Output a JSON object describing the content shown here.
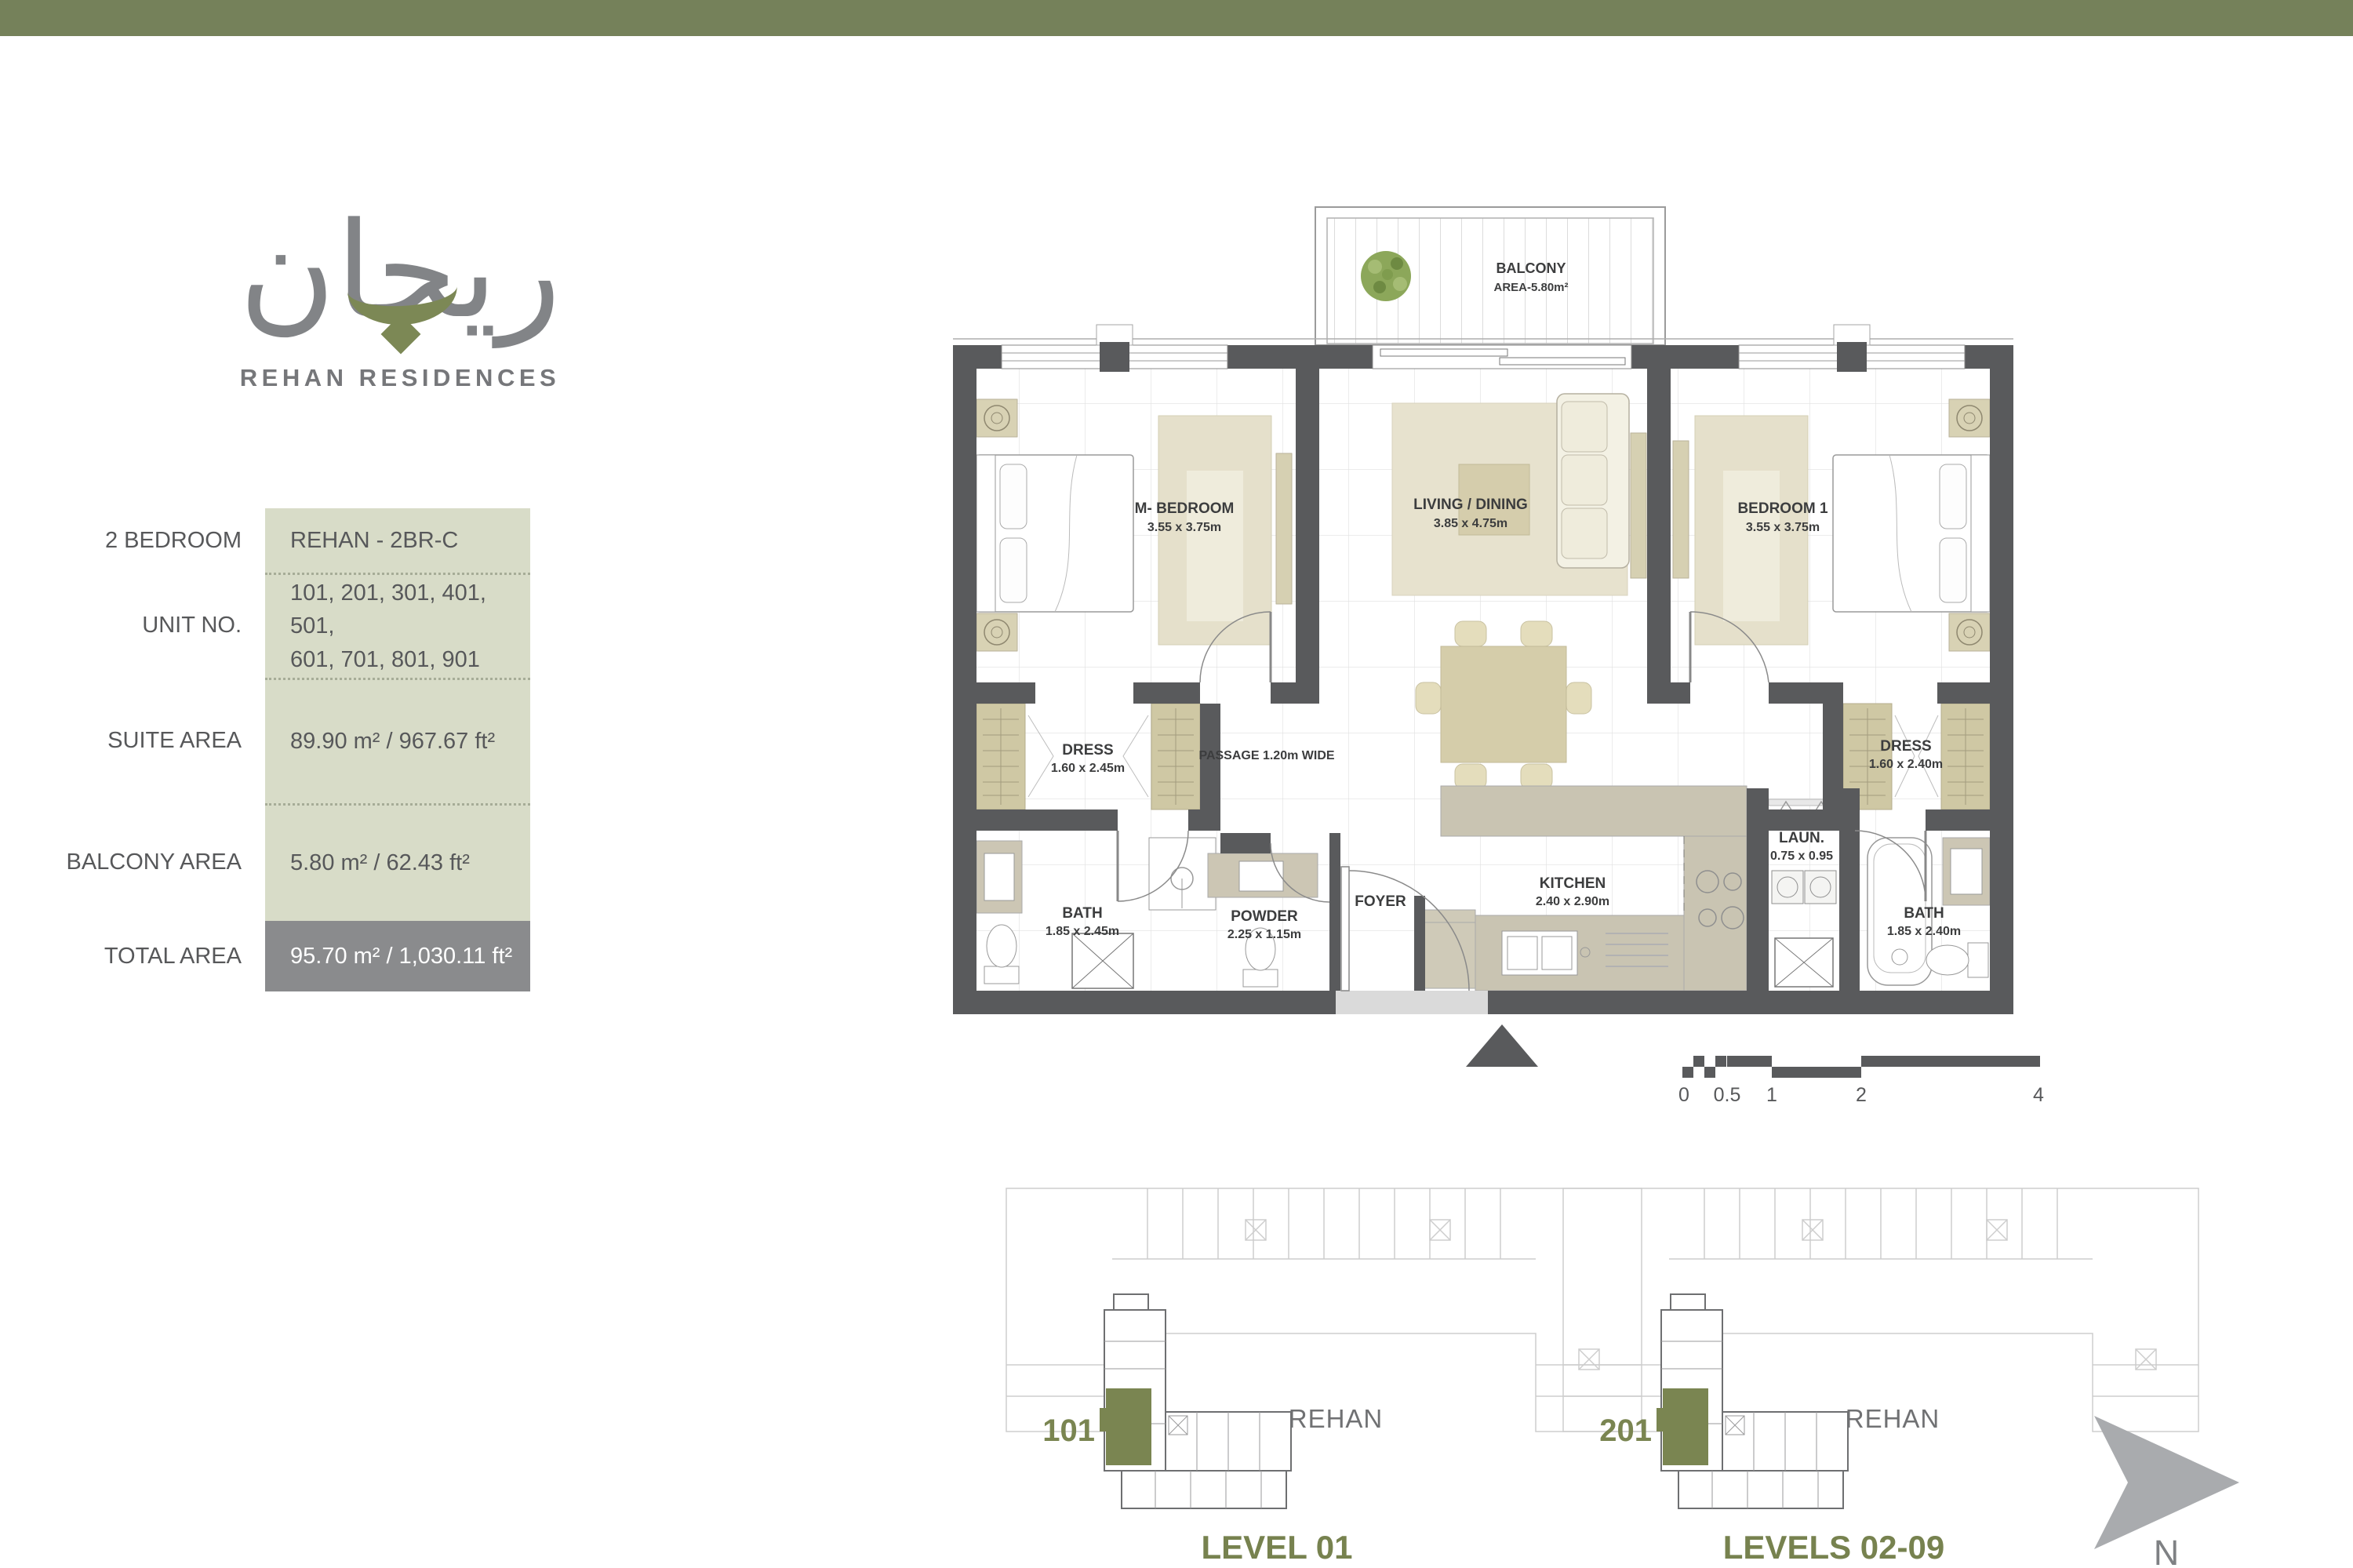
{
  "colors": {
    "top_bar": "#75815A",
    "accent_green": "#7A8551",
    "logo_gray": "#828487",
    "table_value_bg": "#D8DCC8",
    "table_total_bg": "#8A8B8D",
    "wall_gray": "#595A5C",
    "furniture_beige": "#D6D0B2",
    "text_gray": "#58595B"
  },
  "brand": {
    "logo_arabic": "ريحان",
    "logo_subtitle": "REHAN RESIDENCES"
  },
  "info_table": {
    "rows": [
      {
        "label": "2 BEDROOM",
        "value": "REHAN - 2BR-C"
      },
      {
        "label": "UNIT NO.",
        "value_line1": "101, 201, 301, 401, 501,",
        "value_line2": "601, 701, 801, 901"
      },
      {
        "label": "SUITE AREA",
        "value": "89.90 m² / 967.67 ft²"
      },
      {
        "label": "BALCONY AREA",
        "value": "5.80 m² / 62.43 ft²"
      },
      {
        "label": "TOTAL AREA",
        "value": "95.70 m² / 1,030.11 ft²"
      }
    ]
  },
  "floor_plan": {
    "balcony": {
      "name": "BALCONY",
      "dim": "AREA-5.80m²"
    },
    "rooms": {
      "m_bedroom": {
        "name": "M- BEDROOM",
        "dim": "3.55 x 3.75m"
      },
      "living": {
        "name": "LIVING / DINING",
        "dim": "3.85 x 4.75m"
      },
      "bedroom1": {
        "name": "BEDROOM  1",
        "dim": "3.55 x 3.75m"
      },
      "dress_left": {
        "name": "DRESS",
        "dim": "1.60 x 2.45m"
      },
      "passage": {
        "name": "PASSAGE 1.20m WIDE"
      },
      "dress_right": {
        "name": "DRESS",
        "dim": "1.60 x 2.40m"
      },
      "bath_left": {
        "name": "BATH",
        "dim": "1.85 x 2.45m"
      },
      "powder": {
        "name": "POWDER",
        "dim": "2.25 x 1.15m"
      },
      "foyer": {
        "name": "FOYER"
      },
      "kitchen": {
        "name": "KITCHEN",
        "dim": "2.40 x 2.90m"
      },
      "laundry": {
        "name": "LAUN.",
        "dim": "0.75 x 0.95"
      },
      "bath_right": {
        "name": "BATH",
        "dim": "1.85 x 2.40m"
      }
    }
  },
  "scale_bar": {
    "labels": [
      "0",
      "0.5",
      "1",
      "2",
      "4"
    ]
  },
  "key_plans": [
    {
      "unit": "101",
      "building": "REHAN",
      "level": "LEVEL 01"
    },
    {
      "unit": "201",
      "building": "REHAN",
      "level": "LEVELS 02-09"
    }
  ],
  "compass": {
    "label": "N"
  }
}
